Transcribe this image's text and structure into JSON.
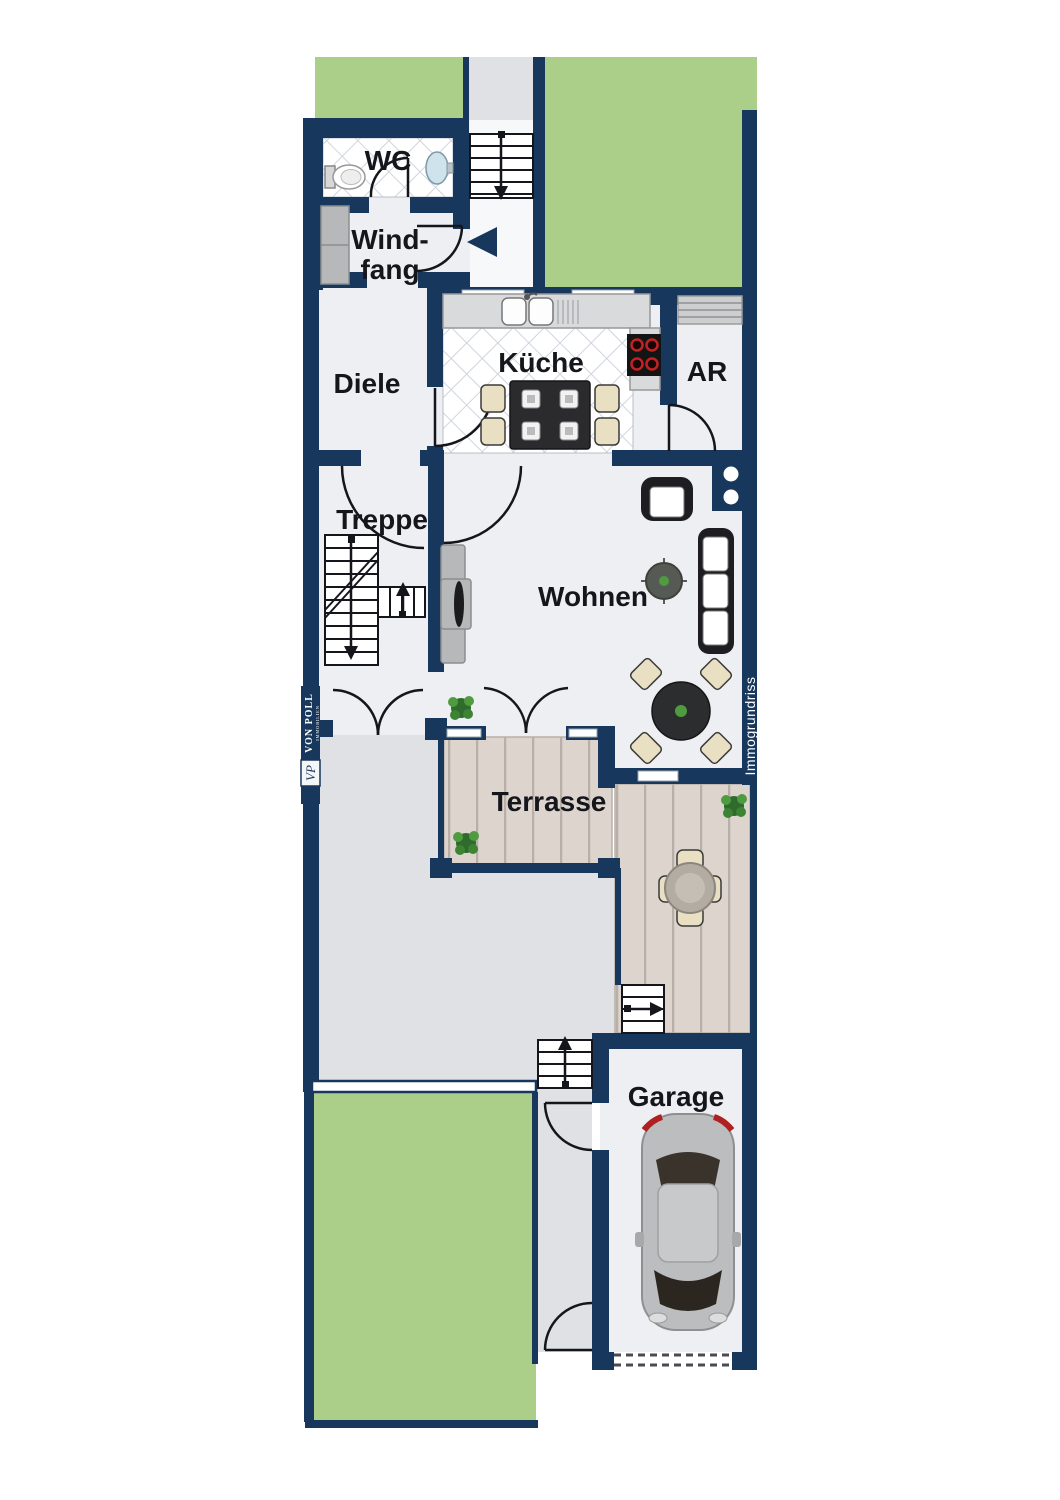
{
  "rooms": {
    "wc": "WC",
    "windfang_line1": "Wind-",
    "windfang_line2": "fang",
    "diele": "Diele",
    "kueche": "Küche",
    "ar": "AR",
    "treppe": "Treppe",
    "wohnen": "Wohnen",
    "terrasse": "Terrasse",
    "garage": "Garage"
  },
  "branding": {
    "logo_line1": "VON POLL",
    "logo_line2": "IMMOBILIEN",
    "logo_monogram": "VP",
    "watermark": "Immogrundriss"
  },
  "colors": {
    "wall": "#17375c",
    "floor": "#edeff3",
    "outdoor": "#e0e1e4",
    "green": "#abcf88",
    "deck": "#dcd4cd",
    "deck_line": "#b8b0a8",
    "tile_line": "#cfd5dd",
    "ink": "#15151c",
    "counter": "#d9dadc",
    "cabinet": "#b6b8ba",
    "chair": "#e9dfc2",
    "furniture_dark": "#1e1e22",
    "stove": "#141414",
    "burner": "#c22222",
    "car_body": "#bcbdbf",
    "sink_blue": "#cfe3ec",
    "plant_dark": "#2f6b2c",
    "plant_light": "#4f9c40"
  }
}
